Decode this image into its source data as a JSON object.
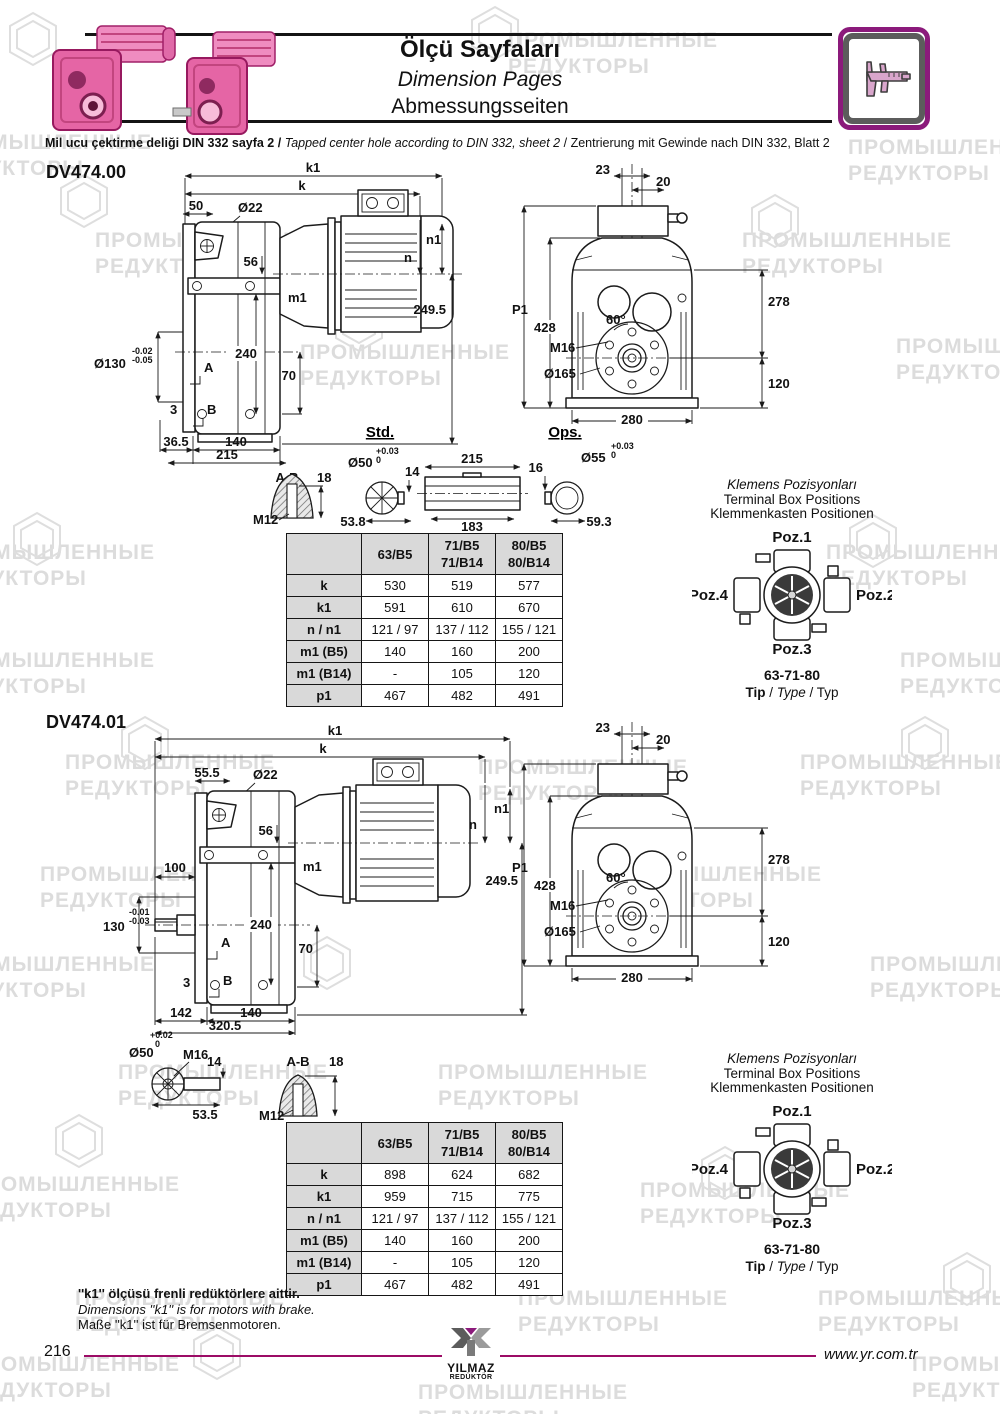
{
  "page": {
    "number": "216",
    "website": "www.yr.com.tr"
  },
  "watermark": {
    "line1": "ПРОМЫШЛЕННЫЕ",
    "line2": "РЕДУКТОРЫ"
  },
  "header": {
    "title_tr": "Ölçü Sayfaları",
    "title_en": "Dimension Pages",
    "title_de": "Abmessungsseiten",
    "note_tr": "Mil ucu çektirme deliği DIN 332 sayfa 2 /",
    "note_en": "Tapped center hole according to DIN 332, sheet 2",
    "note_sep": "/",
    "note_de": "Zentrierung mit Gewinde nach DIN 332, Blatt 2"
  },
  "sections": [
    {
      "model": "DV474.00",
      "side": {
        "k1": "k1",
        "k": "k",
        "dim50": "50",
        "dia22": "Ø22",
        "dim56": "56",
        "m1": "m1",
        "n1": "n1",
        "n": "n",
        "dim249_5": "249.5",
        "dia130": "Ø130",
        "tol130_top": "-0.02",
        "tol130_bot": "-0.05",
        "dim240": "240",
        "A": "A",
        "dim70": "70",
        "dim3": "3",
        "B": "B",
        "dim36_5": "36.5",
        "dim140": "140",
        "dim215": "215"
      },
      "front": {
        "dim23": "23",
        "dim20": "20",
        "P1": "P1",
        "dim428": "428",
        "dim278": "278",
        "deg60": "60°",
        "M16": "M16",
        "dia165": "Ø165",
        "dim120": "120",
        "dim280": "280"
      },
      "detail": {
        "std_label": "Std.",
        "ops_label": "Ops.",
        "ab_label": "A-B",
        "dim18": "18",
        "M12": "M12",
        "dia50": "Ø50",
        "tol50_top": "+0.03",
        "tol50_bot": "0",
        "dim14": "14",
        "dim53_8": "53.8",
        "dim215": "215",
        "dim183": "183",
        "dim16": "16",
        "dia55": "Ø55",
        "tol55_top": "+0.03",
        "tol55_bot": "0",
        "dim59_3": "59.3"
      },
      "table": {
        "headers": [
          {
            "l1": "63/B5",
            "l2": ""
          },
          {
            "l1": "71/B5",
            "l2": "71/B14"
          },
          {
            "l1": "80/B5",
            "l2": "80/B14"
          }
        ],
        "rows": [
          {
            "label": "k",
            "v": [
              "530",
              "519",
              "577"
            ]
          },
          {
            "label": "k1",
            "v": [
              "591",
              "610",
              "670"
            ]
          },
          {
            "label": "n / n1",
            "v": [
              "121 / 97",
              "137 / 112",
              "155 / 121"
            ]
          },
          {
            "label": "m1 (B5)",
            "v": [
              "140",
              "160",
              "200"
            ]
          },
          {
            "label": "m1 (B14)",
            "v": [
              "-",
              "105",
              "120"
            ]
          },
          {
            "label": "p1",
            "v": [
              "467",
              "482",
              "491"
            ]
          }
        ]
      },
      "terminal": {
        "title_tr": "Klemens Pozisyonları",
        "title_en": "Terminal Box Positions",
        "title_de": "Klemmenkasten Positionen",
        "poz1": "Poz.1",
        "poz2": "Poz.2",
        "poz3": "Poz.3",
        "poz4": "Poz.4",
        "sizes": "63-71-80",
        "tip_tr": "Tip",
        "tip_en": "Type",
        "tip_de": "Typ"
      }
    },
    {
      "model": "DV474.01",
      "side": {
        "k1": "k1",
        "k": "k",
        "dim55_5": "55.5",
        "dia22": "Ø22",
        "dim56": "56",
        "m1": "m1",
        "n1": "n1",
        "n": "n",
        "dim249_5": "249.5",
        "dim100": "100",
        "dim130": "130",
        "tol130_top": "-0.01",
        "tol130_bot": "-0.03",
        "dim240": "240",
        "A": "A",
        "dim70": "70",
        "dim3": "3",
        "B": "B",
        "dim142": "142",
        "dim140": "140",
        "dim320_5": "320.5"
      },
      "front": {
        "dim23": "23",
        "dim20": "20",
        "P1": "P1",
        "dim428": "428",
        "dim278": "278",
        "deg60": "60°",
        "M16": "M16",
        "dia165": "Ø165",
        "dim120": "120",
        "dim280": "280"
      },
      "detail": {
        "dia50": "Ø50",
        "tol50_top": "+0.02",
        "tol50_bot": "0",
        "M16": "M16",
        "dim14": "14",
        "dim53_5": "53.5",
        "ab_label": "A-B",
        "dim18": "18",
        "M12": "M12"
      },
      "table": {
        "headers": [
          {
            "l1": "63/B5",
            "l2": ""
          },
          {
            "l1": "71/B5",
            "l2": "71/B14"
          },
          {
            "l1": "80/B5",
            "l2": "80/B14"
          }
        ],
        "rows": [
          {
            "label": "k",
            "v": [
              "898",
              "624",
              "682"
            ]
          },
          {
            "label": "k1",
            "v": [
              "959",
              "715",
              "775"
            ]
          },
          {
            "label": "n / n1",
            "v": [
              "121 / 97",
              "137 / 112",
              "155 / 121"
            ]
          },
          {
            "label": "m1 (B5)",
            "v": [
              "140",
              "160",
              "200"
            ]
          },
          {
            "label": "m1 (B14)",
            "v": [
              "-",
              "105",
              "120"
            ]
          },
          {
            "label": "p1",
            "v": [
              "467",
              "482",
              "491"
            ]
          }
        ]
      },
      "terminal": {
        "title_tr": "Klemens Pozisyonları",
        "title_en": "Terminal Box Positions",
        "title_de": "Klemmenkasten Positionen",
        "poz1": "Poz.1",
        "poz2": "Poz.2",
        "poz3": "Poz.3",
        "poz4": "Poz.4",
        "sizes": "63-71-80",
        "tip_tr": "Tip",
        "tip_en": "Type",
        "tip_de": "Typ"
      }
    }
  ],
  "footnote": {
    "tr": "''k1'' ölçüsü frenli redüktörlere aittir.",
    "en": "Dimensions ''k1'' is for motors with brake.",
    "de": "Maße ''k1'' ist für Bremsenmotoren."
  },
  "logo": {
    "name": "YILMAZ",
    "sub": "REDÜKTÖR"
  }
}
